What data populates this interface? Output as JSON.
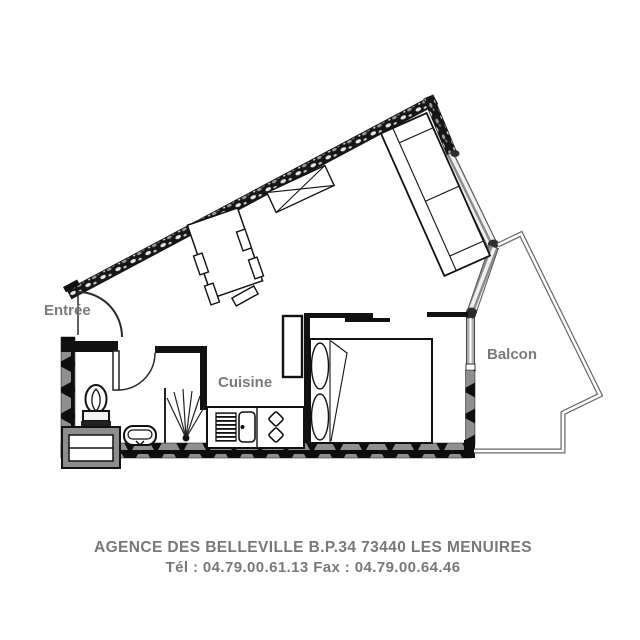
{
  "plan": {
    "labels": {
      "entrance": "Entrée",
      "kitchen": "Cuisine",
      "balcony": "Balcon"
    },
    "footer": {
      "line1": "AGENCE DES BELLEVILLE B.P.34 73440 LES MENUIRES",
      "line2": "Tél : 04.79.00.61.13  Fax : 04.79.00.64.46"
    },
    "colors": {
      "background": "#ffffff",
      "label_gray": "#7a7a7a",
      "wall_black": "#111111",
      "line_dark": "#222222",
      "balcony_outline_gray": "#666666",
      "glazing_gray": "#8a8a8a"
    }
  }
}
